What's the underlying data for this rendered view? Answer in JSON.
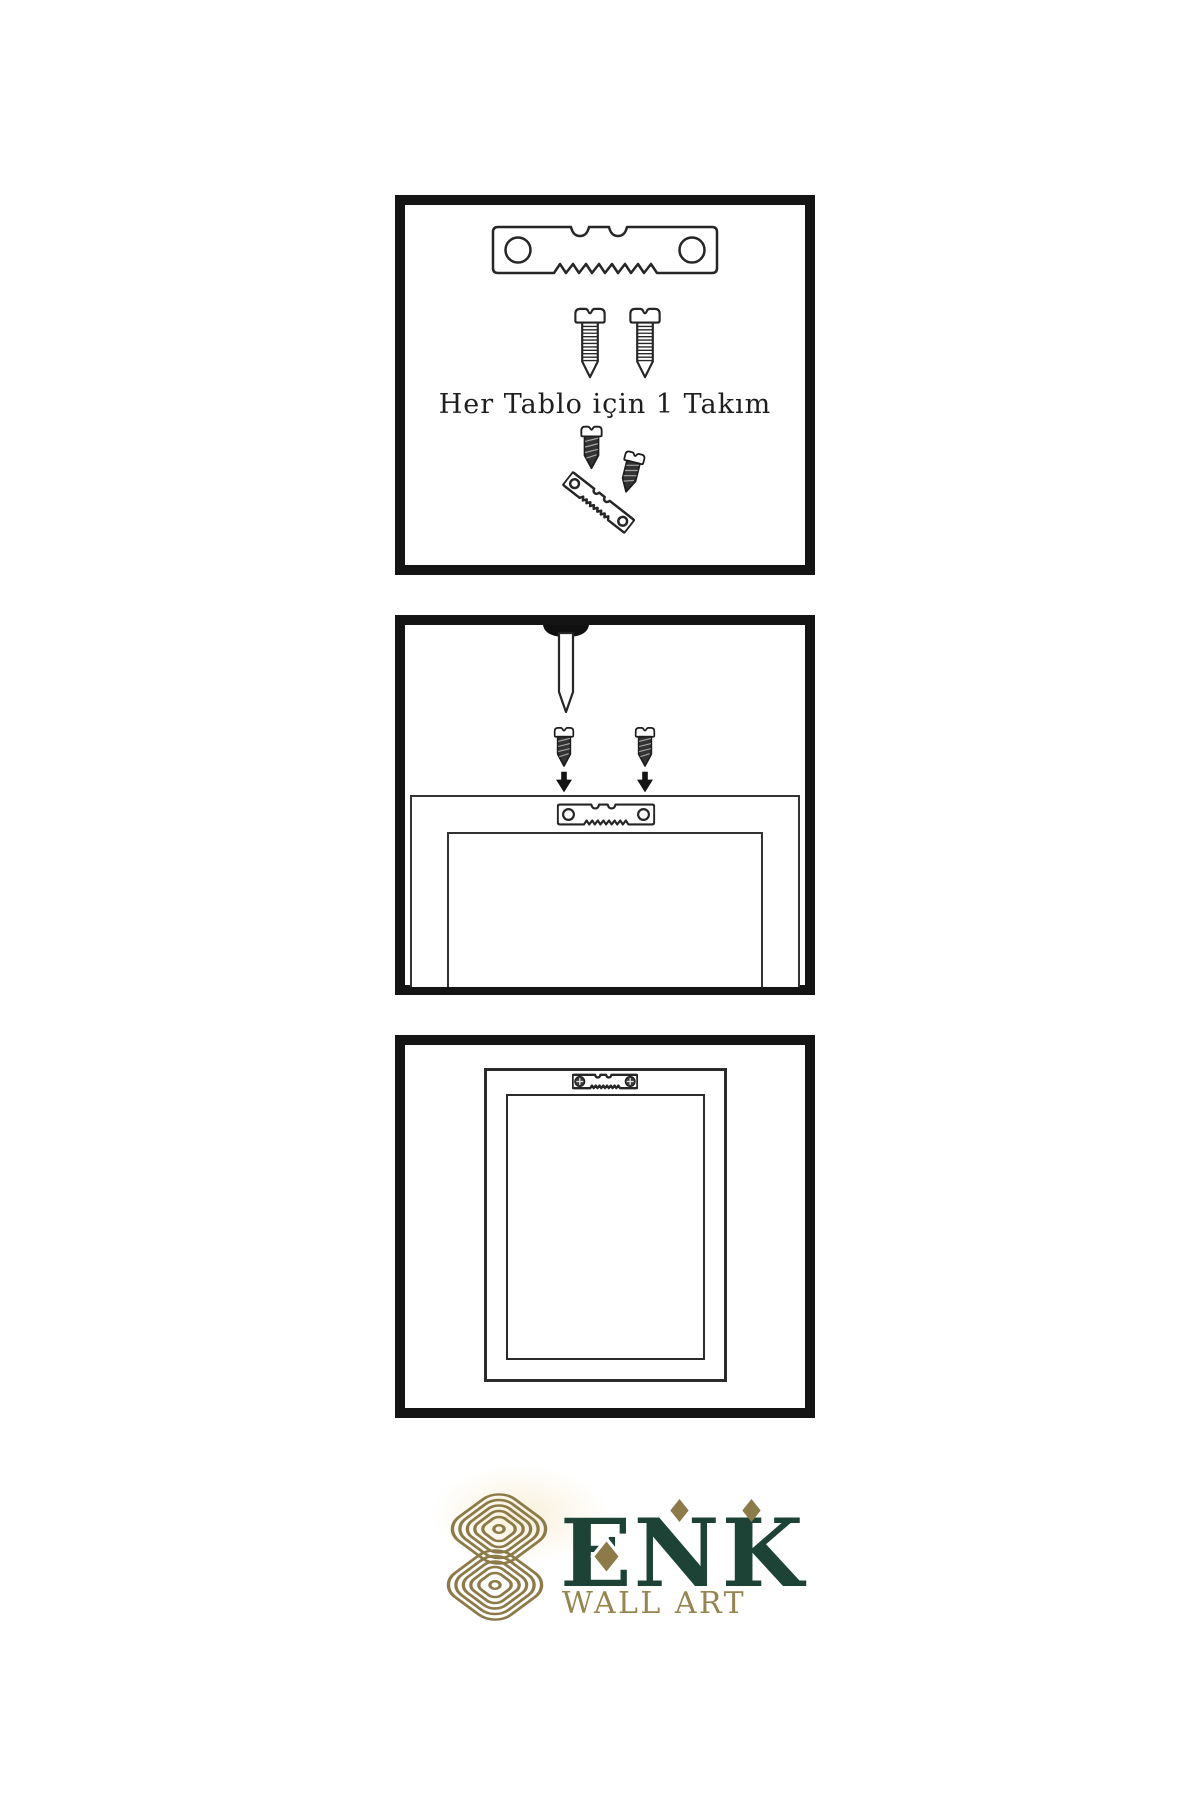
{
  "instructions": {
    "panel_kit": {
      "caption": "Her Tablo için 1 Takım",
      "icons": [
        "sawtooth-hanger",
        "mounting-screw",
        "mounting-screw",
        "screw-driven-into-hanger"
      ]
    },
    "panel_mount": {
      "icons": [
        "wall-nail",
        "mounting-screw-down",
        "mounting-screw-down",
        "down-arrow",
        "down-arrow",
        "frame-back-with-sawtooth-hanger"
      ]
    },
    "panel_hung": {
      "icons": [
        "hanging-frame-with-installed-hanger"
      ]
    }
  },
  "logo": {
    "brand": "ENK",
    "subtitle": "WALL ART",
    "colors": {
      "brand_green": "#1d4336",
      "gold": "#8c7b49"
    }
  },
  "colors": {
    "background": "#ffffff",
    "panel_border": "#141414",
    "line": "#262626",
    "dark_fill": "#333333"
  }
}
